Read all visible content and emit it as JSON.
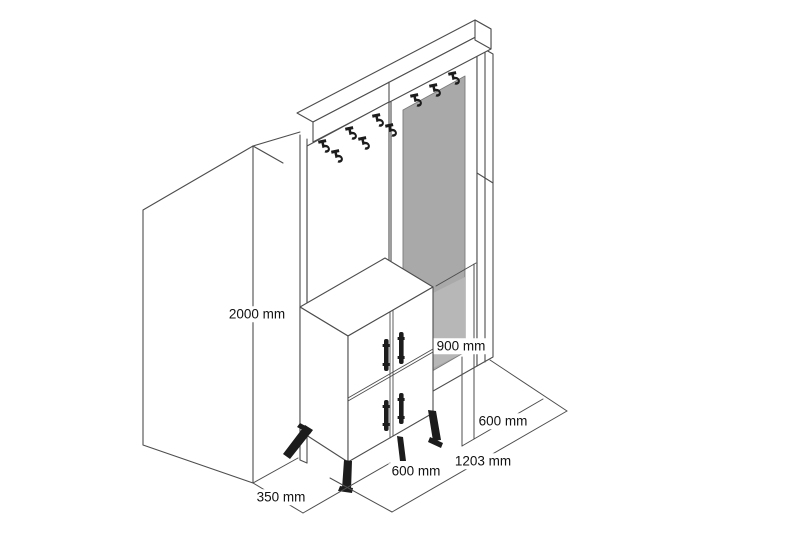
{
  "figure": {
    "kind": "isometric technical dimension drawing",
    "subject": "hallway unit with coat-hook panel, mirror panel and 4-door shoe cabinet on metal legs",
    "visible_counts": {
      "coat_hooks": 9,
      "cabinet_doors": 4,
      "door_handles": 4,
      "legs": 4
    }
  },
  "dimensions": {
    "total_height": {
      "label": "2000 mm"
    },
    "cabinet_height": {
      "label": "900 mm"
    },
    "right_section_depth": {
      "label": "600 mm"
    },
    "total_width": {
      "label": "1203 mm"
    },
    "cabinet_width": {
      "label": "600 mm"
    },
    "side_depth": {
      "label": "350 mm"
    }
  },
  "colors": {
    "background": "#ffffff",
    "line": "#4d4d4d",
    "mirror_gray": "#a9a9a9",
    "mirror_light_gray": "#b7b7b7",
    "hardware_black": "#1c1c1c",
    "text": "#111111"
  }
}
